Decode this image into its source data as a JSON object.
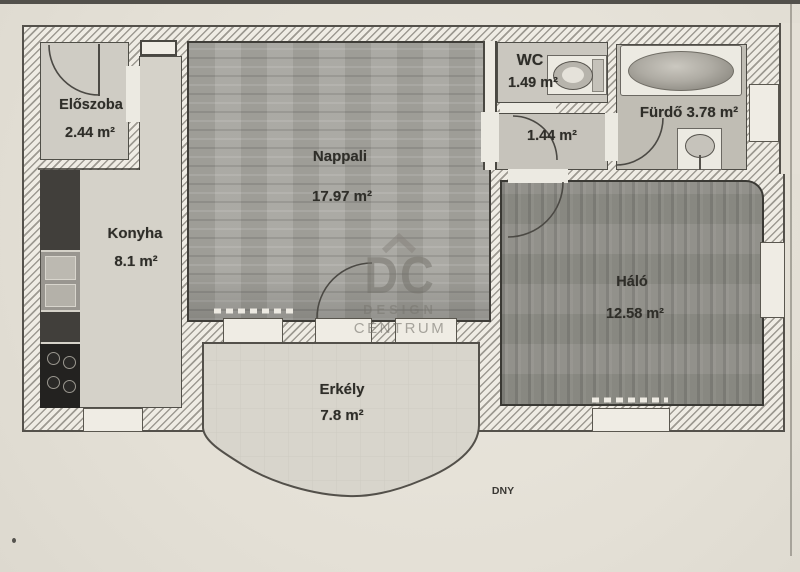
{
  "scan": {
    "orientation_label": "DNY"
  },
  "watermark": {
    "logo": "DC",
    "line1": "DESIGN",
    "line2": "CENTRUM",
    "roof_icon": "roof-chevron-icon"
  },
  "rooms": [
    {
      "name": "Előszoba",
      "area": "2.44 m²"
    },
    {
      "name": "Konyha",
      "area": "8.1 m²"
    },
    {
      "name": "Nappali",
      "area": "17.97 m²"
    },
    {
      "name": "WC",
      "area": "1.49 m²"
    },
    {
      "name": "",
      "area": "1.44 m²"
    },
    {
      "name": "Fürdő",
      "area": "3.78 m²"
    },
    {
      "name": "Háló",
      "area": "12.58 m²"
    },
    {
      "name": "Erkély",
      "area": "7.8 m²"
    }
  ],
  "fixtures": [
    "bathtub",
    "sink",
    "toilet",
    "stove",
    "kitchen-counter",
    "refrigerator"
  ],
  "colors": {
    "paper": "#e7e3da",
    "wall_hatch_bg": "#efece4",
    "wall_line": "#54514b",
    "living_floor": "#a6a59f",
    "bedroom_floor": "#8e8d86",
    "light_floor": "#d3d0c7",
    "balcony_floor": "#d8d5cc",
    "cabinet_dark": "#413f3b",
    "stove_black": "#232220"
  }
}
